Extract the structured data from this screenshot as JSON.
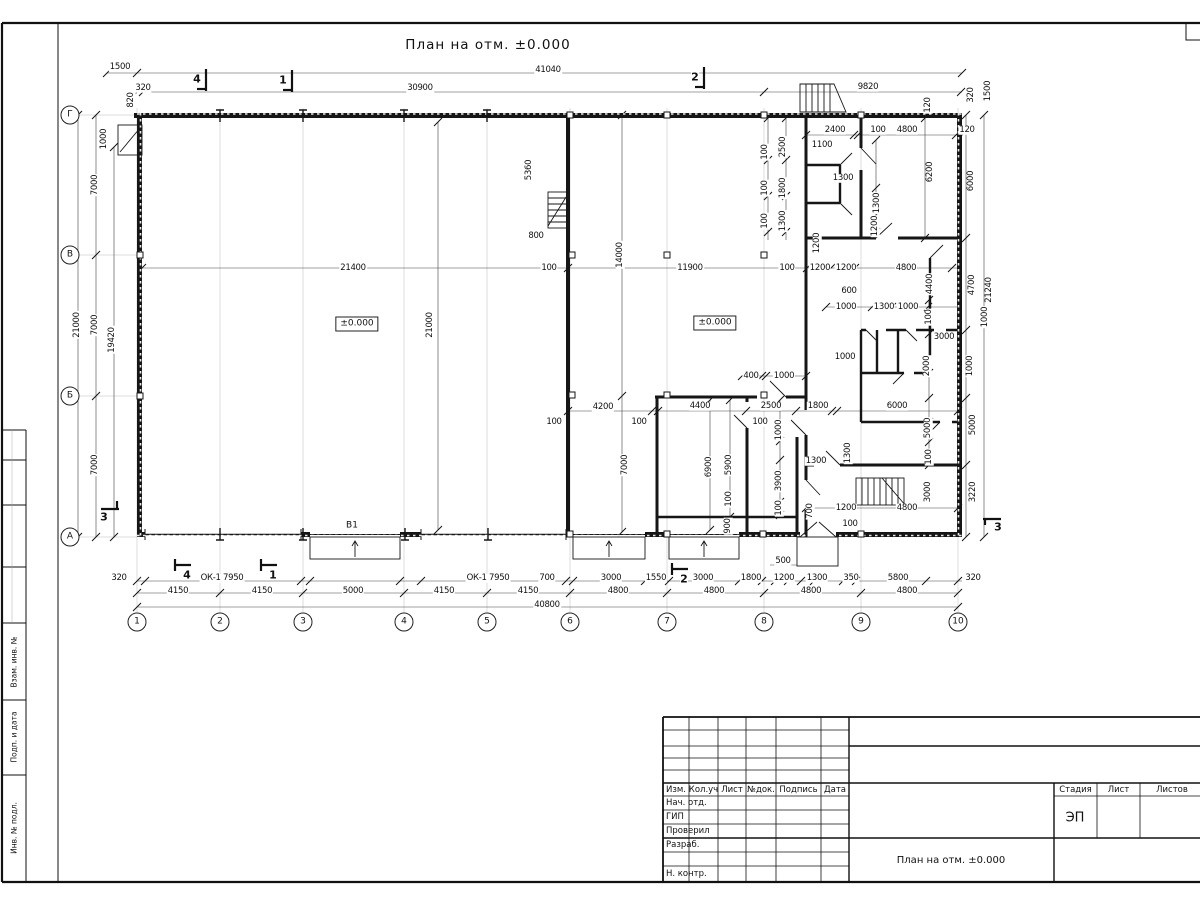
{
  "page": {
    "title": "План на отм. ±0.000"
  },
  "axes": {
    "bottom": [
      {
        "n": "1",
        "x": 137
      },
      {
        "n": "2",
        "x": 220
      },
      {
        "n": "3",
        "x": 303
      },
      {
        "n": "4",
        "x": 404
      },
      {
        "n": "5",
        "x": 487
      },
      {
        "n": "6",
        "x": 570
      },
      {
        "n": "7",
        "x": 667
      },
      {
        "n": "8",
        "x": 764
      },
      {
        "n": "9",
        "x": 861
      },
      {
        "n": "10",
        "x": 958
      }
    ],
    "left": [
      {
        "n": "Г",
        "y": 115
      },
      {
        "n": "В",
        "y": 255
      },
      {
        "n": "Б",
        "y": 396
      },
      {
        "n": "А",
        "y": 537
      }
    ]
  },
  "plan_labels": [
    {
      "t": "±0.000",
      "x": 357,
      "y": 324,
      "box": true
    },
    {
      "t": "±0.000",
      "x": 715,
      "y": 323,
      "box": true
    },
    {
      "t": "В1",
      "x": 352,
      "y": 526,
      "box": false
    }
  ],
  "section_markers": [
    {
      "t": "4",
      "x": 197,
      "y": 79,
      "k": "t"
    },
    {
      "t": "1",
      "x": 283,
      "y": 80,
      "k": "t"
    },
    {
      "t": "2",
      "x": 695,
      "y": 77,
      "k": "t"
    },
    {
      "t": "4",
      "x": 187,
      "y": 575,
      "k": "b"
    },
    {
      "t": "1",
      "x": 273,
      "y": 575,
      "k": "b"
    },
    {
      "t": "2",
      "x": 684,
      "y": 579,
      "k": "b"
    },
    {
      "t": "3",
      "x": 104,
      "y": 517,
      "k": "l"
    },
    {
      "t": "3",
      "x": 998,
      "y": 527,
      "k": "r"
    }
  ],
  "dims": [
    {
      "t": "1500",
      "x": 120,
      "y": 67
    },
    {
      "t": "41040",
      "x": 548,
      "y": 70
    },
    {
      "t": "320",
      "x": 143,
      "y": 88
    },
    {
      "t": "30900",
      "x": 420,
      "y": 88
    },
    {
      "t": "9820",
      "x": 868,
      "y": 87
    },
    {
      "t": "820",
      "x": 131,
      "y": 100,
      "r": 1
    },
    {
      "t": "1000",
      "x": 104,
      "y": 139,
      "r": 1
    },
    {
      "t": "320",
      "x": 971,
      "y": 95,
      "r": 1
    },
    {
      "t": "1500",
      "x": 988,
      "y": 91,
      "r": 1
    },
    {
      "t": "120",
      "x": 928,
      "y": 105,
      "r": 1
    },
    {
      "t": "2400",
      "x": 835,
      "y": 130
    },
    {
      "t": "100",
      "x": 878,
      "y": 130
    },
    {
      "t": "4800",
      "x": 907,
      "y": 130
    },
    {
      "t": "120",
      "x": 967,
      "y": 130
    },
    {
      "t": "1100",
      "x": 822,
      "y": 145
    },
    {
      "t": "2500",
      "x": 783,
      "y": 147,
      "r": 1
    },
    {
      "t": "100",
      "x": 765,
      "y": 152,
      "r": 1
    },
    {
      "t": "1800",
      "x": 783,
      "y": 188,
      "r": 1
    },
    {
      "t": "100",
      "x": 765,
      "y": 188,
      "r": 1
    },
    {
      "t": "1300",
      "x": 783,
      "y": 221,
      "r": 1
    },
    {
      "t": "100",
      "x": 765,
      "y": 221,
      "r": 1
    },
    {
      "t": "1300",
      "x": 843,
      "y": 178
    },
    {
      "t": "1300",
      "x": 877,
      "y": 203,
      "r": 1
    },
    {
      "t": "1200",
      "x": 875,
      "y": 226,
      "r": 1
    },
    {
      "t": "1200",
      "x": 817,
      "y": 243,
      "r": 1
    },
    {
      "t": "6200",
      "x": 930,
      "y": 172,
      "r": 1
    },
    {
      "t": "6000",
      "x": 971,
      "y": 181,
      "r": 1
    },
    {
      "t": "5360",
      "x": 529,
      "y": 170,
      "r": 1
    },
    {
      "t": "800",
      "x": 536,
      "y": 236
    },
    {
      "t": "21400",
      "x": 353,
      "y": 268
    },
    {
      "t": "100",
      "x": 549,
      "y": 268
    },
    {
      "t": "14000",
      "x": 620,
      "y": 255,
      "r": 1
    },
    {
      "t": "11900",
      "x": 690,
      "y": 268
    },
    {
      "t": "100",
      "x": 787,
      "y": 268
    },
    {
      "t": "1200",
      "x": 820,
      "y": 268
    },
    {
      "t": "1200",
      "x": 846,
      "y": 268
    },
    {
      "t": "4800",
      "x": 906,
      "y": 268
    },
    {
      "t": "21000",
      "x": 430,
      "y": 325,
      "r": 1
    },
    {
      "t": "4400",
      "x": 930,
      "y": 284,
      "r": 1
    },
    {
      "t": "4700",
      "x": 972,
      "y": 285,
      "r": 1
    },
    {
      "t": "21240",
      "x": 989,
      "y": 290,
      "r": 1
    },
    {
      "t": "600",
      "x": 849,
      "y": 291
    },
    {
      "t": "1000",
      "x": 846,
      "y": 307
    },
    {
      "t": "1300",
      "x": 884,
      "y": 307
    },
    {
      "t": "1000",
      "x": 908,
      "y": 307
    },
    {
      "t": "100",
      "x": 929,
      "y": 317,
      "r": 1
    },
    {
      "t": "1000",
      "x": 985,
      "y": 317,
      "r": 1
    },
    {
      "t": "3000",
      "x": 944,
      "y": 337
    },
    {
      "t": "1000",
      "x": 845,
      "y": 357
    },
    {
      "t": "2000",
      "x": 927,
      "y": 366,
      "r": 1
    },
    {
      "t": "1000",
      "x": 970,
      "y": 366,
      "r": 1
    },
    {
      "t": "400",
      "x": 751,
      "y": 376
    },
    {
      "t": "1000",
      "x": 784,
      "y": 376
    },
    {
      "t": "4200",
      "x": 603,
      "y": 407
    },
    {
      "t": "4400",
      "x": 700,
      "y": 406
    },
    {
      "t": "2500",
      "x": 771,
      "y": 406
    },
    {
      "t": "1800",
      "x": 818,
      "y": 406
    },
    {
      "t": "6000",
      "x": 897,
      "y": 406
    },
    {
      "t": "100",
      "x": 554,
      "y": 422
    },
    {
      "t": "100",
      "x": 639,
      "y": 422
    },
    {
      "t": "100",
      "x": 760,
      "y": 422
    },
    {
      "t": "1000",
      "x": 779,
      "y": 430,
      "r": 1
    },
    {
      "t": "5000",
      "x": 928,
      "y": 428,
      "r": 1
    },
    {
      "t": "5000",
      "x": 973,
      "y": 425,
      "r": 1
    },
    {
      "t": "1300",
      "x": 816,
      "y": 461
    },
    {
      "t": "1300",
      "x": 848,
      "y": 453,
      "r": 1
    },
    {
      "t": "7000",
      "x": 625,
      "y": 465,
      "r": 1
    },
    {
      "t": "6900",
      "x": 709,
      "y": 467,
      "r": 1
    },
    {
      "t": "5900",
      "x": 729,
      "y": 465,
      "r": 1
    },
    {
      "t": "3900",
      "x": 779,
      "y": 481,
      "r": 1
    },
    {
      "t": "100",
      "x": 729,
      "y": 499,
      "r": 1
    },
    {
      "t": "100",
      "x": 779,
      "y": 508,
      "r": 1
    },
    {
      "t": "900",
      "x": 728,
      "y": 526,
      "r": 1
    },
    {
      "t": "700",
      "x": 810,
      "y": 511,
      "r": 1
    },
    {
      "t": "100",
      "x": 929,
      "y": 457,
      "r": 1
    },
    {
      "t": "3000",
      "x": 928,
      "y": 492,
      "r": 1
    },
    {
      "t": "3220",
      "x": 973,
      "y": 492,
      "r": 1
    },
    {
      "t": "1200",
      "x": 846,
      "y": 508
    },
    {
      "t": "4800",
      "x": 907,
      "y": 508
    },
    {
      "t": "100",
      "x": 850,
      "y": 524
    },
    {
      "t": "500",
      "x": 783,
      "y": 561
    },
    {
      "t": "7000",
      "x": 95,
      "y": 185,
      "r": 1
    },
    {
      "t": "7000",
      "x": 95,
      "y": 325,
      "r": 1
    },
    {
      "t": "7000",
      "x": 95,
      "y": 465,
      "r": 1
    },
    {
      "t": "21000",
      "x": 77,
      "y": 325,
      "r": 1
    },
    {
      "t": "19420",
      "x": 112,
      "y": 340,
      "r": 1
    },
    {
      "t": "320",
      "x": 119,
      "y": 578
    },
    {
      "t": "ОК-1 7950",
      "x": 222,
      "y": 578
    },
    {
      "t": "ОК-1 7950",
      "x": 488,
      "y": 578
    },
    {
      "t": "700",
      "x": 547,
      "y": 578
    },
    {
      "t": "3000",
      "x": 611,
      "y": 578
    },
    {
      "t": "1550",
      "x": 656,
      "y": 578
    },
    {
      "t": "3000",
      "x": 703,
      "y": 578
    },
    {
      "t": "1800",
      "x": 751,
      "y": 578
    },
    {
      "t": "1200",
      "x": 784,
      "y": 578
    },
    {
      "t": "1300",
      "x": 817,
      "y": 578
    },
    {
      "t": "350",
      "x": 851,
      "y": 578
    },
    {
      "t": "5800",
      "x": 898,
      "y": 578
    },
    {
      "t": "320",
      "x": 973,
      "y": 578
    },
    {
      "t": "4150",
      "x": 178,
      "y": 591
    },
    {
      "t": "4150",
      "x": 262,
      "y": 591
    },
    {
      "t": "5000",
      "x": 353,
      "y": 591
    },
    {
      "t": "4150",
      "x": 444,
      "y": 591
    },
    {
      "t": "4150",
      "x": 528,
      "y": 591
    },
    {
      "t": "4800",
      "x": 618,
      "y": 591
    },
    {
      "t": "4800",
      "x": 714,
      "y": 591
    },
    {
      "t": "4800",
      "x": 811,
      "y": 591
    },
    {
      "t": "4800",
      "x": 907,
      "y": 591
    },
    {
      "t": "40800",
      "x": 547,
      "y": 605
    }
  ],
  "title_block": {
    "header_cols": [
      "Изм.",
      "Кол.уч",
      "Лист",
      "№док.",
      "Подпись",
      "Дата"
    ],
    "sign_rows": [
      "Нач. отд.",
      "ГИП",
      "Проверил",
      "Разраб.",
      "",
      "Н. контр."
    ],
    "stage_cols": [
      "Стадия",
      "Лист",
      "Листов"
    ],
    "stage_value": "ЭП",
    "doc_title": "План на отм. ±0.000"
  },
  "side_strip": {
    "labels": [
      "Взам. инв. №",
      "Подп. и дата",
      "Инв. № подл."
    ]
  }
}
